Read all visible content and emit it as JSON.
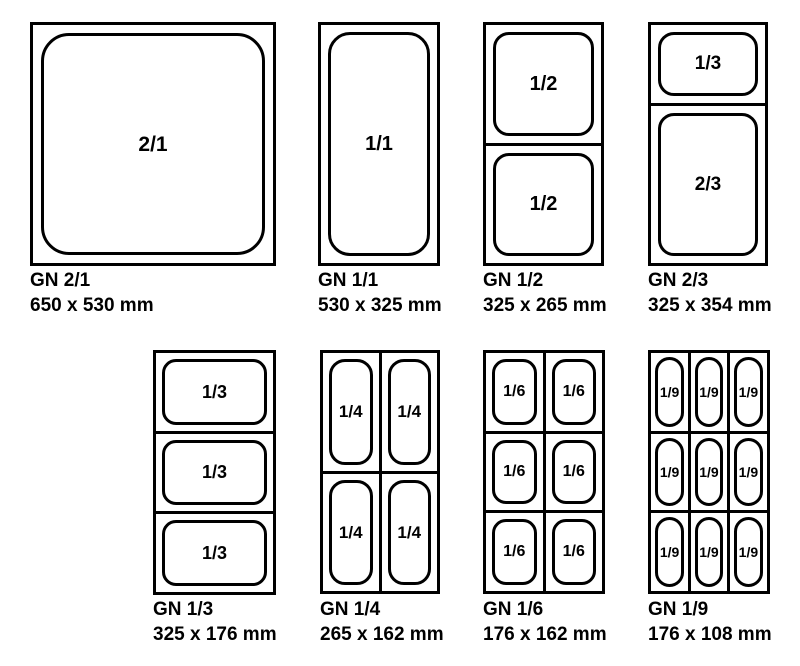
{
  "colors": {
    "line": "#000000",
    "background": "#ffffff",
    "text": "#000000"
  },
  "pans": [
    {
      "id": "gn-2-1",
      "caption_line1": "GN 2/1",
      "caption_line2": "650 x 530 mm",
      "box": {
        "left": 30,
        "top": 22,
        "width": 246,
        "height": 244
      },
      "caption_top": 271,
      "rows": [
        1
      ],
      "cols": [
        1
      ],
      "cells": [
        [
          "2/1"
        ]
      ],
      "inner_inset": 8,
      "inner_radius": 28,
      "label_size": 21
    },
    {
      "id": "gn-1-1",
      "caption_line1": "GN 1/1",
      "caption_line2": "530 x 325 mm",
      "box": {
        "left": 318,
        "top": 22,
        "width": 122,
        "height": 244
      },
      "caption_top": 271,
      "rows": [
        1
      ],
      "cols": [
        1
      ],
      "cells": [
        [
          "1/1"
        ]
      ],
      "inner_inset": 7,
      "inner_radius": 22,
      "label_size": 20
    },
    {
      "id": "gn-1-2",
      "caption_line1": "GN 1/2",
      "caption_line2": "325 x 265 mm",
      "box": {
        "left": 483,
        "top": 22,
        "width": 121,
        "height": 244
      },
      "caption_top": 271,
      "rows": [
        1,
        1
      ],
      "cols": [
        1
      ],
      "cells": [
        [
          "1/2"
        ],
        [
          "1/2"
        ]
      ],
      "inner_inset": 7,
      "inner_radius": 16,
      "label_size": 20
    },
    {
      "id": "gn-2-3",
      "caption_line1": "GN 2/3",
      "caption_line2": "325 x 354 mm",
      "box": {
        "left": 648,
        "top": 22,
        "width": 120,
        "height": 244
      },
      "caption_top": 271,
      "rows": [
        1,
        2
      ],
      "cols": [
        1
      ],
      "cells": [
        [
          "1/3"
        ],
        [
          "2/3"
        ]
      ],
      "inner_inset": 7,
      "inner_radius": 16,
      "label_size": 19
    },
    {
      "id": "gn-1-3",
      "caption_line1": "GN 1/3",
      "caption_line2": "325 x 176 mm",
      "box": {
        "left": 153,
        "top": 350,
        "width": 123,
        "height": 245
      },
      "caption_top": 600,
      "rows": [
        1,
        1,
        1
      ],
      "cols": [
        1
      ],
      "cells": [
        [
          "1/3"
        ],
        [
          "1/3"
        ],
        [
          "1/3"
        ]
      ],
      "inner_inset": 6,
      "inner_radius": 14,
      "label_size": 18
    },
    {
      "id": "gn-1-4",
      "caption_line1": "GN 1/4",
      "caption_line2": "265 x 162 mm",
      "box": {
        "left": 320,
        "top": 350,
        "width": 120,
        "height": 244
      },
      "caption_top": 600,
      "rows": [
        1,
        1
      ],
      "cols": [
        1,
        1
      ],
      "cells": [
        [
          "1/4",
          "1/4"
        ],
        [
          "1/4",
          "1/4"
        ]
      ],
      "inner_inset": 6,
      "inner_radius": 16,
      "label_size": 17
    },
    {
      "id": "gn-1-6",
      "caption_line1": "GN 1/6",
      "caption_line2": "176 x 162 mm",
      "box": {
        "left": 483,
        "top": 350,
        "width": 122,
        "height": 244
      },
      "caption_top": 600,
      "rows": [
        1,
        1,
        1
      ],
      "cols": [
        1,
        1
      ],
      "cells": [
        [
          "1/6",
          "1/6"
        ],
        [
          "1/6",
          "1/6"
        ],
        [
          "1/6",
          "1/6"
        ]
      ],
      "inner_inset": 6,
      "inner_radius": 14,
      "label_size": 16
    },
    {
      "id": "gn-1-9",
      "caption_line1": "GN 1/9",
      "caption_line2": "176 x 108 mm",
      "box": {
        "left": 648,
        "top": 350,
        "width": 122,
        "height": 244
      },
      "caption_top": 600,
      "rows": [
        1,
        1,
        1
      ],
      "cols": [
        1,
        1,
        1
      ],
      "cells": [
        [
          "1/9",
          "1/9",
          "1/9"
        ],
        [
          "1/9",
          "1/9",
          "1/9"
        ],
        [
          "1/9",
          "1/9",
          "1/9"
        ]
      ],
      "inner_inset": 4,
      "inner_radius": 18,
      "label_size": 14
    }
  ]
}
